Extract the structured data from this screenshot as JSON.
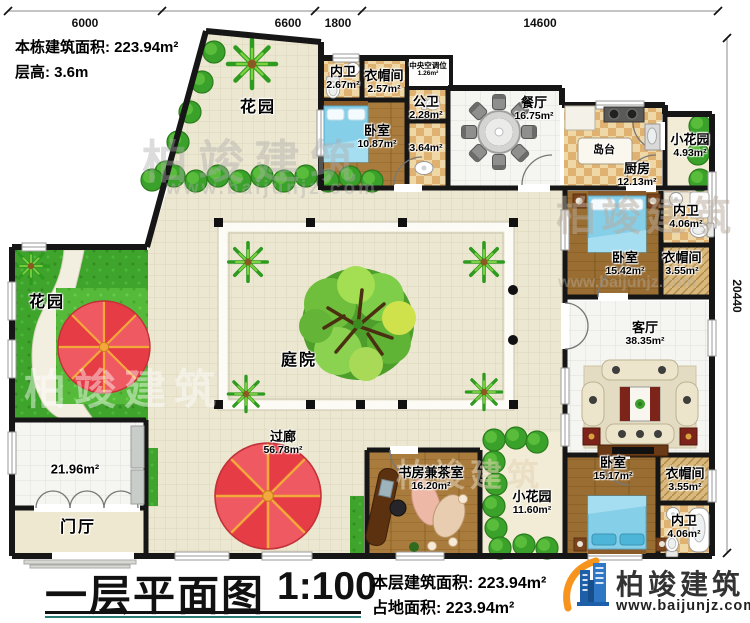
{
  "info": {
    "building_area": "本栋建筑面积: 223.94m²",
    "floor_height": "层高: 3.6m"
  },
  "dimensions": {
    "top": [
      "6000",
      "6600",
      "1800",
      "14600"
    ],
    "right": "20440"
  },
  "rooms": [
    {
      "id": "garden-top",
      "name": "花园",
      "area": ""
    },
    {
      "id": "bath-1",
      "name": "内卫",
      "area": "2.67m²"
    },
    {
      "id": "cloak-1",
      "name": "衣帽间",
      "area": "2.57m²"
    },
    {
      "id": "bedroom-1",
      "name": "卧室",
      "area": "10.87m²"
    },
    {
      "id": "public-bath",
      "name": "公卫",
      "area": "2.28m²"
    },
    {
      "id": "wash-corridor",
      "name": "",
      "area": "3.64m²"
    },
    {
      "id": "hvac",
      "name": "中央空调位",
      "area": "1.26m²"
    },
    {
      "id": "dining",
      "name": "餐厅",
      "area": "16.75m²"
    },
    {
      "id": "island",
      "name": "岛台",
      "area": ""
    },
    {
      "id": "kitchen",
      "name": "厨房",
      "area": "12.13m²"
    },
    {
      "id": "small-garden-1",
      "name": "小花园",
      "area": "4.93m²"
    },
    {
      "id": "bath-2",
      "name": "内卫",
      "area": "4.06m²"
    },
    {
      "id": "bedroom-2",
      "name": "卧室",
      "area": "15.42m²"
    },
    {
      "id": "cloak-2",
      "name": "衣帽间",
      "area": "3.55m²"
    },
    {
      "id": "living",
      "name": "客厅",
      "area": "38.35m²"
    },
    {
      "id": "bedroom-3",
      "name": "卧室",
      "area": "15.17m²"
    },
    {
      "id": "cloak-3",
      "name": "衣帽间",
      "area": "3.55m²"
    },
    {
      "id": "bath-3",
      "name": "内卫",
      "area": "4.06m²"
    },
    {
      "id": "study",
      "name": "书房兼茶室",
      "area": "16.20m²"
    },
    {
      "id": "small-garden-2",
      "name": "小花园",
      "area": "11.60m²"
    },
    {
      "id": "garden-left",
      "name": "花园",
      "area": ""
    },
    {
      "id": "side-room",
      "name": "",
      "area": "21.96m²"
    },
    {
      "id": "foyer",
      "name": "门厅",
      "area": ""
    },
    {
      "id": "courtyard",
      "name": "庭院",
      "area": ""
    },
    {
      "id": "corridor",
      "name": "过廊",
      "area": "56.78m²"
    }
  ],
  "title_block": {
    "title": "一层平面图",
    "scale": "1:100",
    "floor_area": "本层建筑面积: 223.94m²",
    "site_area": "占地面积: 223.94m²"
  },
  "logo": {
    "name": "柏竣建筑",
    "url": "www.baijunjz.com"
  },
  "watermark": {
    "text": "柏竣建筑",
    "url": "www.baijunjz.com"
  }
}
